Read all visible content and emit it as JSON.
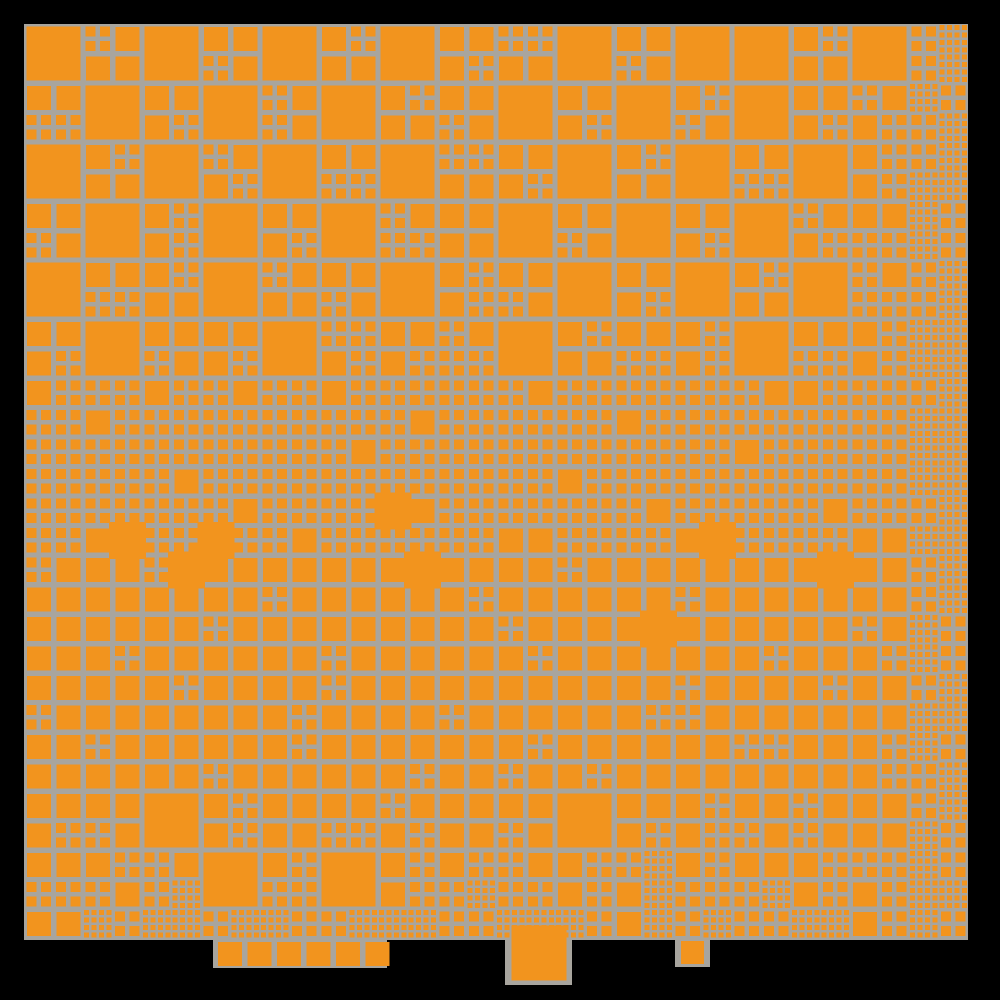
{
  "scene": {
    "kind": "quadtree-halftone-mosaic",
    "palette": {
      "frame": "#000000",
      "canvas_gray": "#a8a59e",
      "square_orange": "#f2941e"
    },
    "canvas": {
      "x": 24,
      "y": 24,
      "w": 944,
      "h": 916
    },
    "grid": {
      "cell": 59,
      "quad": 29.5,
      "cols": 16,
      "rows": 15
    },
    "square_sizes": {
      "4": 54,
      "5": 24,
      "6": 10,
      "7": 4.9,
      "8": 37
    },
    "blocks": [
      [
        "4",
        "6555",
        "4",
        "5565",
        "4",
        "5655",
        "4",
        "5556",
        "6655",
        "4",
        "5565",
        "4",
        "4",
        "5655",
        "4",
        "6767"
      ],
      [
        "5566",
        "4",
        "5556",
        "4",
        "6565",
        "4",
        "5655",
        "5565",
        "4",
        "5556",
        "4",
        "5665",
        "4",
        "5556",
        "6556",
        "7667"
      ],
      [
        "4",
        "5655",
        "4",
        "6556",
        "4",
        "5566",
        "4",
        "6655",
        "5556",
        "4",
        "5655",
        "4",
        "5566",
        "4",
        "5656",
        "6777"
      ],
      [
        "5565",
        "4",
        "5656",
        "4",
        "5556",
        "4",
        "6566",
        "5555",
        "4",
        "5565",
        "4",
        "5556",
        "4",
        "6556",
        "5566",
        "7676"
      ],
      [
        "4",
        "5566",
        "5655",
        "4",
        "6555",
        "5565",
        "4",
        "5656",
        "5565",
        "4",
        "5556",
        "4",
        "5655",
        "4",
        "6566",
        "6767"
      ],
      [
        "5556",
        "4",
        "5565",
        "5556",
        "4",
        "6656",
        "5556",
        "6566",
        "4",
        "5655",
        "5566",
        "5656",
        "4",
        "5566",
        "5656",
        "7777"
      ],
      [
        "5666",
        "6656",
        "5666",
        "6566",
        "6666",
        "5666",
        "6665",
        "6666",
        "6566",
        "6666",
        "6656",
        "6666",
        "6566",
        "5666",
        "6666",
        "6777"
      ],
      [
        "6666",
        "6666",
        "6665",
        "6666",
        "6666",
        "6566",
        "6666",
        "6666",
        "6666",
        "6656",
        "6666",
        "6666",
        "5666",
        "6666",
        "6666",
        "7777"
      ],
      [
        "6666",
        "6658",
        "6666",
        "6586",
        "6665",
        "6666",
        "8566",
        "6666",
        "6655",
        "6666",
        "6566",
        "6658",
        "6666",
        "6566",
        "6655",
        "6777"
      ],
      [
        "6555",
        "5555",
        "6855",
        "5555",
        "5565",
        "5555",
        "5855",
        "5556",
        "5555",
        "6555",
        "5555",
        "5565",
        "5555",
        "5855",
        "5555",
        "6767"
      ],
      [
        "5555",
        "5556",
        "5555",
        "6555",
        "5555",
        "5565",
        "5555",
        "5555",
        "6556",
        "5555",
        "5855",
        "5555",
        "5556",
        "5555",
        "6556",
        "7676"
      ],
      [
        "5565",
        "5555",
        "5655",
        "5555",
        "5556",
        "6555",
        "5555",
        "5565",
        "5555",
        "5555",
        "5556",
        "6565",
        "5555",
        "5655",
        "5555",
        "6777"
      ],
      [
        "5555",
        "6555",
        "5555",
        "5565",
        "5655",
        "5555",
        "5556",
        "5555",
        "5665",
        "5556",
        "5555",
        "5555",
        "6655",
        "5555",
        "5656",
        "7667"
      ],
      [
        "5556",
        "5565",
        "4",
        "5656",
        "5555",
        "5566",
        "6556",
        "5555",
        "5565",
        "4",
        "5556",
        "5656",
        "5565",
        "6565",
        "5555",
        "6776"
      ],
      [
        "5566",
        "5665",
        "6567",
        "4",
        "5666",
        "4",
        "5656",
        "5667",
        "6566",
        "5656",
        "6757",
        "5666",
        "5567",
        "5656",
        "6656",
        "7677"
      ]
    ],
    "half_row": {
      "y": 909,
      "cell": 29.5,
      "codes": [
        "5",
        "5",
        "7",
        "6",
        "7",
        "7",
        "6",
        "7",
        "7",
        "6",
        "6",
        "7",
        "7",
        "7",
        "6",
        "6",
        "7",
        "7",
        "7",
        "6",
        "5",
        "7",
        "6",
        "7",
        "6",
        "6",
        "7",
        "7",
        "5",
        "6",
        "7",
        "6"
      ]
    },
    "tabs": [
      {
        "name": "bottom-tab-left",
        "rect": {
          "x": 213,
          "y": 936,
          "w": 174,
          "h": 32
        },
        "squares": [
          {
            "x": 218.0,
            "y": 942,
            "s": 24
          },
          {
            "x": 247.5,
            "y": 942,
            "s": 24
          },
          {
            "x": 277.0,
            "y": 942,
            "s": 24
          },
          {
            "x": 306.5,
            "y": 942,
            "s": 24
          },
          {
            "x": 336.0,
            "y": 942,
            "s": 24
          },
          {
            "x": 365.5,
            "y": 942,
            "s": 24
          }
        ]
      },
      {
        "name": "bottom-tab-center",
        "rect": {
          "x": 505,
          "y": 936,
          "w": 67,
          "h": 49
        },
        "squares": [
          {
            "x": 511.5,
            "y": 925.5,
            "s": 55
          }
        ]
      },
      {
        "name": "bottom-tab-right",
        "rect": {
          "x": 675,
          "y": 936,
          "w": 35,
          "h": 31
        },
        "squares": [
          {
            "x": 681,
            "y": 941,
            "s": 23
          }
        ]
      }
    ]
  }
}
